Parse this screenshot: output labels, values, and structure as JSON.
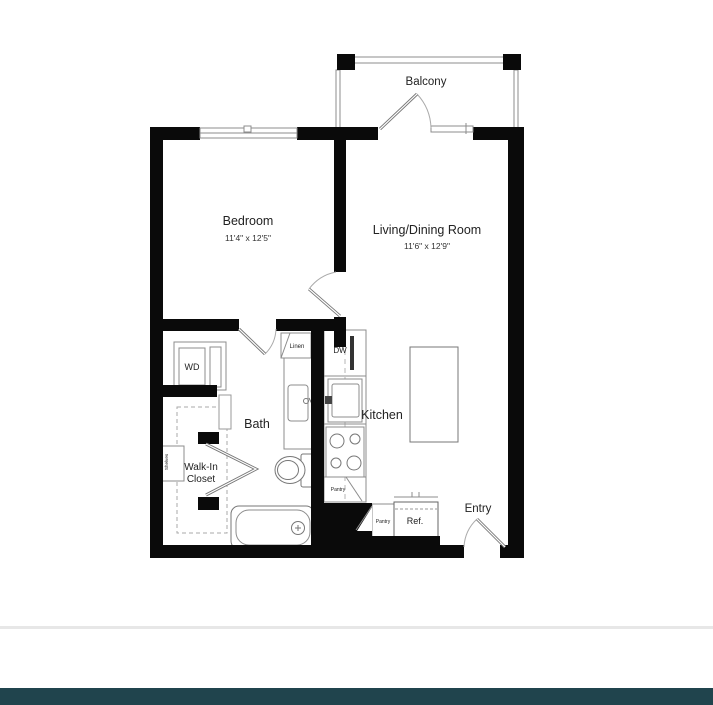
{
  "plan": {
    "rooms": {
      "bedroom": {
        "label": "Bedroom",
        "dims": "11'4\" x 12'5\""
      },
      "living": {
        "label": "Living/Dining Room",
        "dims": "11'6\" x 12'9\""
      },
      "bath": {
        "label": "Bath"
      },
      "closet": {
        "line1": "Walk-In",
        "line2": "Closet"
      },
      "kitchen": {
        "label": "Kitchen"
      },
      "balcony": {
        "label": "Balcony"
      },
      "entry": {
        "label": "Entry"
      }
    },
    "fixtures": {
      "washer_dryer": "WD",
      "dishwasher": "DW",
      "linen": "Linen",
      "pantry_kitchen": "Pantry",
      "pantry_entry": "Pantry",
      "refrigerator": "Ref.",
      "shelves": "Shelves"
    },
    "colors": {
      "wall": "#0a0a0a",
      "thin_line": "#8c8c8c",
      "footer": "#20444d",
      "divider": "#e7e7e7"
    }
  }
}
